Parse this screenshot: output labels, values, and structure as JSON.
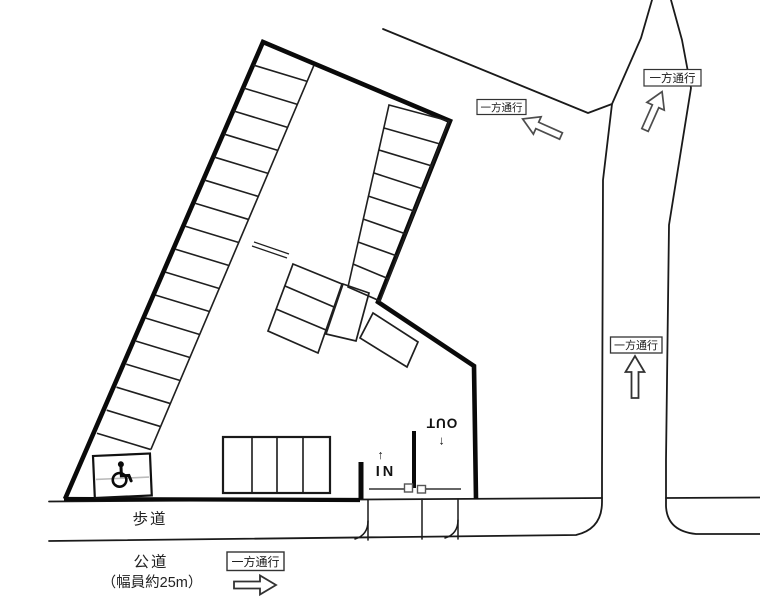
{
  "site_plan": {
    "labels": {
      "sidewalk": "歩道",
      "public_road": "公道",
      "public_road_width": "（幅員約25m）",
      "in": "IN",
      "out": "OUT",
      "in_arrow": "↑",
      "out_arrow": "↓"
    },
    "signs": {
      "one_way": "一方通行"
    },
    "icons": {
      "wheelchair": "wheelchair-accessible-icon"
    },
    "colors": {
      "background": "#ffffff",
      "road_line": "#1a1a1a",
      "boundary": "#0a0a0a",
      "stall_line": "#1f1f1f",
      "accessible_divider": "#bbbbbb",
      "arrow_outline_light": "#4d4d4d",
      "arrow_outline_dark": "#333333"
    }
  }
}
